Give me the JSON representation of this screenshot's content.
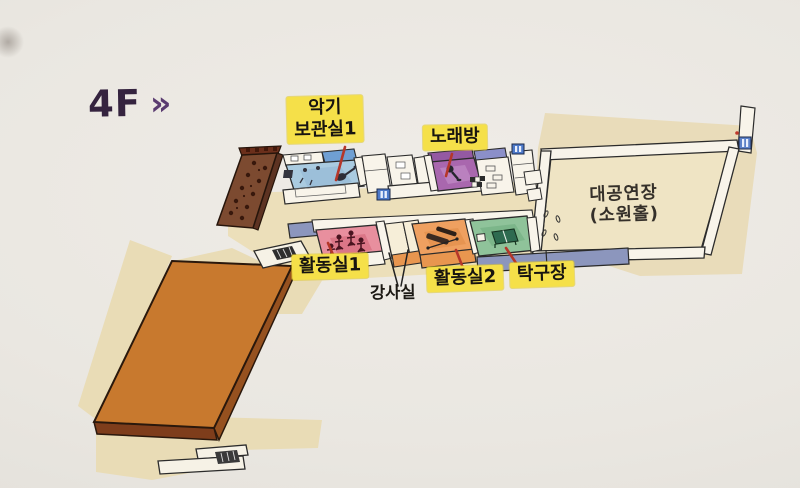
{
  "page": {
    "kind": "floor-guide-map",
    "floor_label": "4F",
    "floor_arrows": "»"
  },
  "palette": {
    "paper": "#eae7e2",
    "title_text": "#35233f",
    "title_arrows": "#5a3b70",
    "label_highlight": "#f5e049",
    "label_text": "#171410",
    "pointer_line": "#b5372a",
    "ink_outline": "#2b2b2b",
    "corridor_blue": "#8c96bd",
    "roof_orange": "#c8792e",
    "terrace_brown": "#7c4a30",
    "walkway_beige": "#ecdfba"
  },
  "rooms": [
    {
      "id": "instrument-storage-1",
      "name": "악기 보관실1",
      "label_line1": "악기",
      "label_line2": "보관실1",
      "color": "#aacbe0",
      "highlighted": true
    },
    {
      "id": "karaoke",
      "name": "노래방",
      "color": "#a967ae",
      "highlighted": true
    },
    {
      "id": "grand-hall",
      "name": "대공연장 (소원홀)",
      "label_line1": "대공연장",
      "label_line2": "(소원홀)",
      "color": "#efe4c4",
      "highlighted": false
    },
    {
      "id": "activity-room-1",
      "name": "활동실1",
      "color": "#e88f9e",
      "highlighted": true
    },
    {
      "id": "instructor-room",
      "name": "강사실",
      "color": "#f6eed8",
      "highlighted": false
    },
    {
      "id": "activity-room-2",
      "name": "활동실2",
      "color": "#efa060",
      "highlighted": true
    },
    {
      "id": "table-tennis",
      "name": "탁구장",
      "color": "#8fc39a",
      "highlighted": true
    }
  ],
  "icons": {
    "elevator": "blue-square-doors",
    "guitar": "dark-guitar-silhouette",
    "microphone": "dark-mic-silhouette",
    "people_exercising": "stick-figures",
    "exercise_equipment": "dark-bars",
    "table_tennis_table": "green-table-with-net",
    "stairs": "hatched-steps",
    "terrace_tables": "small-dark-tables"
  }
}
